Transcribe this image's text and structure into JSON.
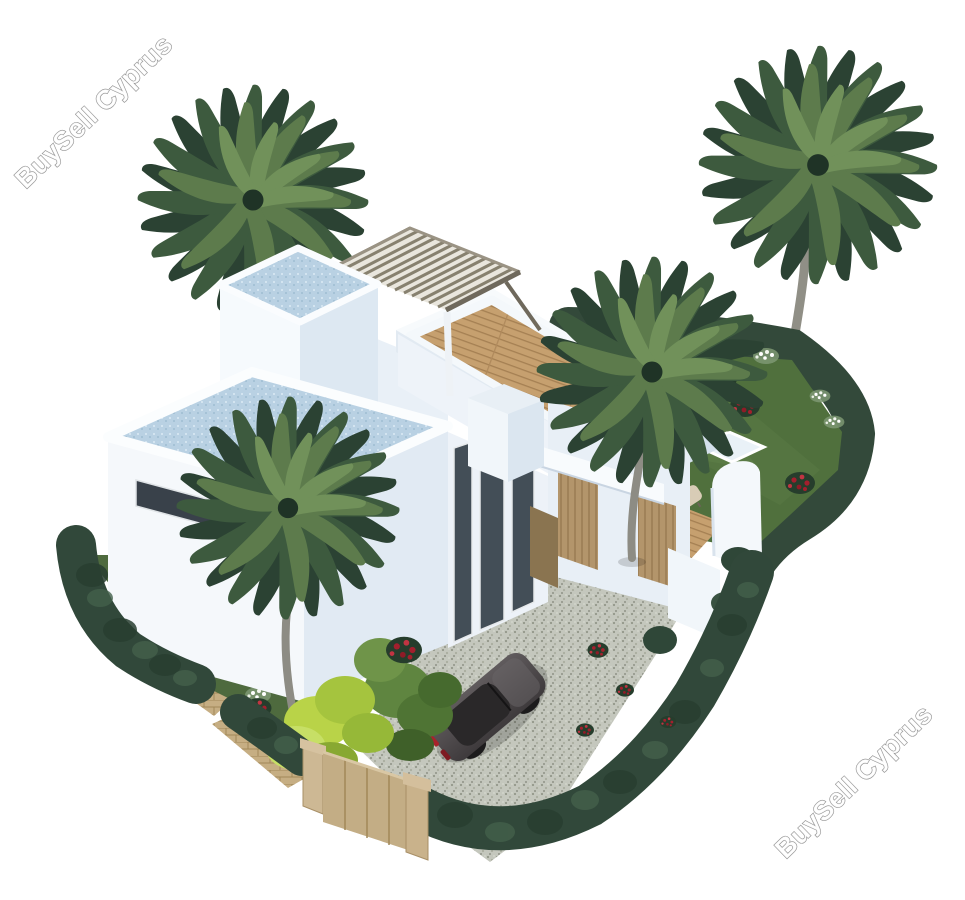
{
  "page": {
    "background_color": "#ffffff",
    "content_type": "3D architectural property rendering (aerial view)"
  },
  "watermarks": {
    "top_left": {
      "text": "BuySell Cyprus",
      "rotation_deg": -44,
      "style": "white fill with grey outline"
    },
    "bottom_right": {
      "text": "BuySell Cyprus",
      "rotation_deg": -44,
      "style": "white fill with grey outline"
    }
  },
  "scene": {
    "description": "Aerial 3D render of a modern two-storey white villa with slatted rooftop pergola, roof terraces, wooden sun deck with two loungers, four palm trees, lawn garden with red and white flower bushes, perimeter hedge, beige gate and fence, gravel driveway and a parked dark grey sports car",
    "elements": [
      "white modern villa",
      "rooftop pergola",
      "roof terrace wooden deck",
      "tiled flat roofs",
      "stair tower",
      "tall dark glazing",
      "wooden entrance doors",
      "palm tree top-left",
      "palm tree top-right",
      "palm tree garden-middle",
      "palm tree front",
      "lawn garden",
      "perimeter hedge",
      "white flower bushes",
      "red flower bushes",
      "chartreuse shrub",
      "green shrub",
      "ground wood deck with two sun loungers",
      "white garden walls and gate",
      "gravel driveway",
      "dark grey sports car",
      "beige boundary fence and gate pillars",
      "paver path"
    ],
    "colors": {
      "villa_walls_light": "#f5f8fb",
      "villa_walls_shaded": "#e1eaf3",
      "roof_tiles": "#b9d1e3",
      "pergola_slats": "#87816f",
      "wood_deck": "#c6a06f",
      "hedge": "#31483a",
      "lawn": "#50703d",
      "gravel": "#c4c7bd",
      "car_body": "#4f4b4d",
      "car_taillight": "#a8232b",
      "fence_beige": "#c3ad85",
      "palm_foliage_dark": "#2b4233",
      "palm_foliage_light": "#5d7b4c",
      "palm_trunk": "#8d8c84",
      "flowers_red": "#a31f2d",
      "flowers_white": "#ffffff",
      "chartreuse_shrub": "#b9d348",
      "sun_lounger": "#d8ccb6"
    }
  }
}
